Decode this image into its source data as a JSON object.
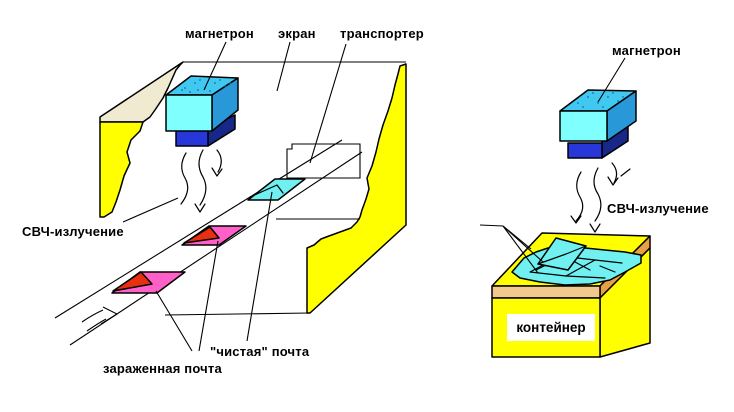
{
  "left": {
    "labels": {
      "magnetron": "магнетрон",
      "screen": "экран",
      "conveyor": "транспортер",
      "radiation": "СВЧ-излучение",
      "clean_mail": "\"чистая\" почта",
      "infected_mail": "зараженная почта"
    }
  },
  "right": {
    "labels": {
      "magnetron": "магнетрон",
      "radiation": "СВЧ-излучение",
      "container": "контейнер"
    }
  },
  "colors": {
    "background": "#ffffff",
    "outline": "#000000",
    "wall_yellow": "#ffff00",
    "wall_tan": "#f0ead0",
    "magnetron_front": "#80ffff",
    "magnetron_top": "#40c8f0",
    "magnetron_side": "#2898d8",
    "magnetron_dots": "#1070a8",
    "horn_front": "#2838d8",
    "horn_side": "#182888",
    "mail_infected": "#ff60c8",
    "mail_flap_red": "#e83010",
    "mail_clean": "#70f0f0",
    "container_rim": "#f2c98c",
    "container_rim_side": "#e8a048",
    "label_bg": "#ffffff"
  }
}
